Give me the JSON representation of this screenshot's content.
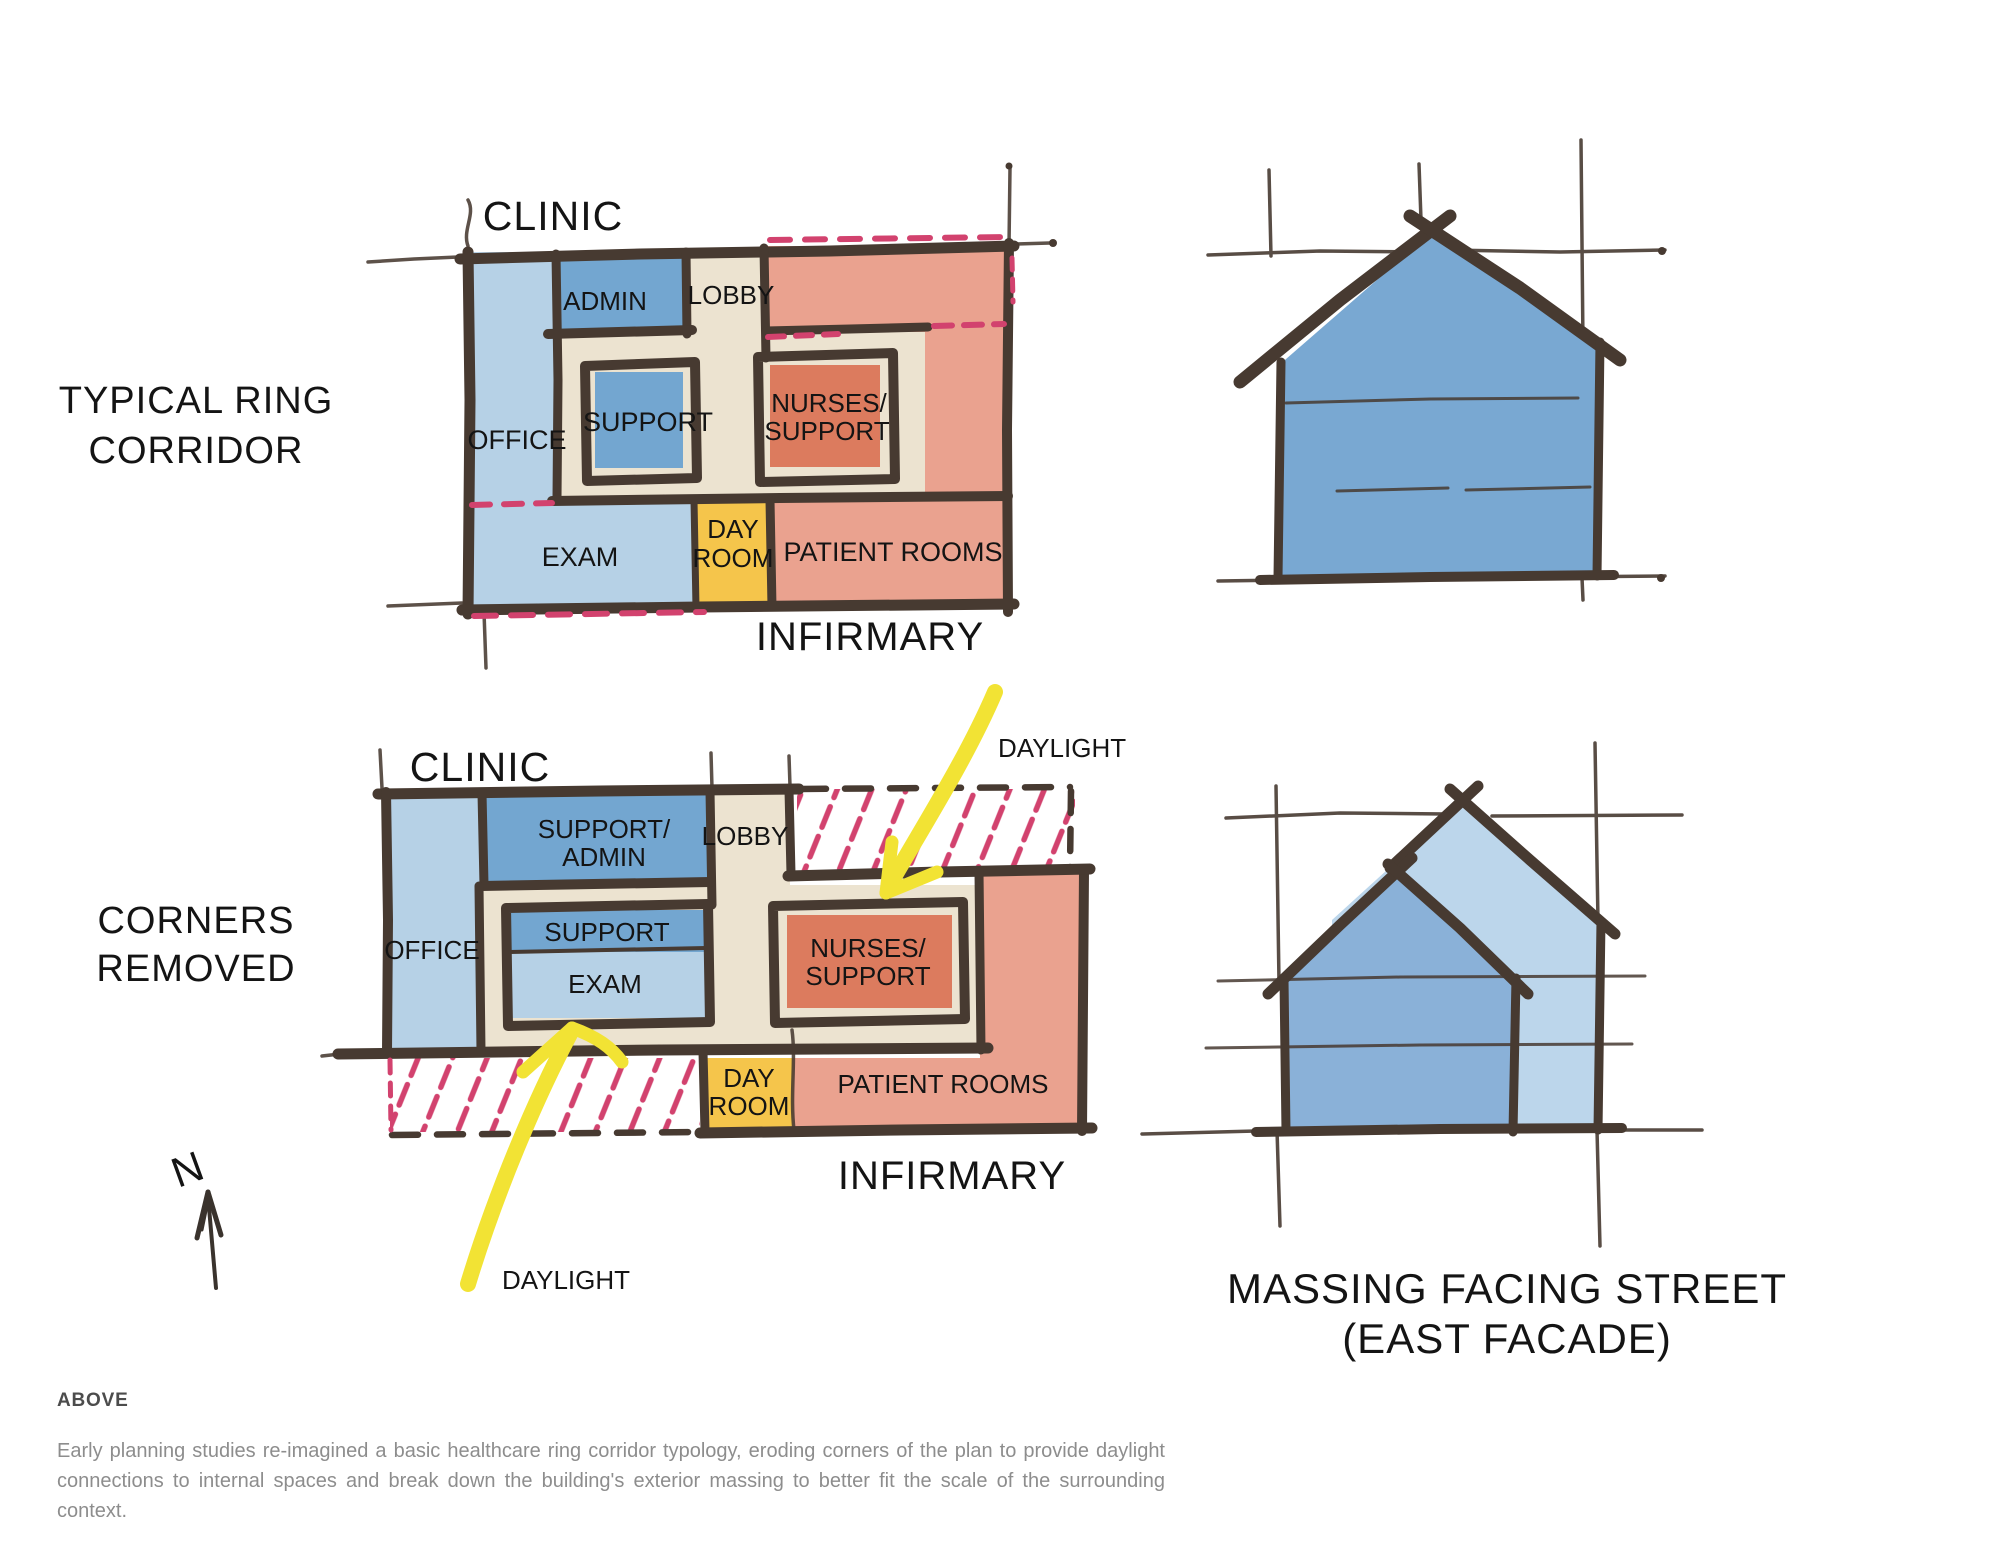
{
  "colors": {
    "ink": "#473a31",
    "light_blue": "#b6d1e6",
    "medium_blue": "#73a6d0",
    "pale_blue_massing": "#bcd6eb",
    "front_blue_massing": "#8ab1d8",
    "cream": "#ece3d0",
    "salmon": "#eaa28f",
    "dark_salmon": "#dc7b5e",
    "day_yellow": "#f5c54b",
    "highlight_yellow": "#f2e334",
    "pink": "#d2426e"
  },
  "plan1": {
    "section_title": [
      "TYPICAL RING",
      "CORRIDOR"
    ],
    "label_top": "CLINIC",
    "label_bottom": "INFIRMARY",
    "rooms": {
      "admin": "ADMIN",
      "lobby": "LOBBY",
      "office": "OFFICE",
      "support": "SUPPORT",
      "nurses": [
        "NURSES/",
        "SUPPORT"
      ],
      "exam": "EXAM",
      "dayroom": [
        "DAY",
        "ROOM"
      ],
      "patient": "PATIENT ROOMS"
    }
  },
  "plan2": {
    "section_title": [
      "CORNERS",
      "REMOVED"
    ],
    "label_top": "CLINIC",
    "label_bottom": "INFIRMARY",
    "rooms": {
      "support_admin": [
        "SUPPORT/",
        "ADMIN"
      ],
      "lobby": "LOBBY",
      "office": "OFFICE",
      "support": "SUPPORT",
      "exam": "EXAM",
      "nurses": [
        "NURSES/",
        "SUPPORT"
      ],
      "dayroom": [
        "DAY",
        "ROOM"
      ],
      "patient": "PATIENT ROOMS"
    },
    "annotations": {
      "daylight_top": "DAYLIGHT",
      "daylight_bottom": "DAYLIGHT"
    }
  },
  "massing": {
    "title": [
      "MASSING FACING STREET",
      "(EAST FACADE)"
    ]
  },
  "compass": {
    "label": "N"
  },
  "caption": {
    "heading": "ABOVE",
    "body": "Early planning studies re-imagined a basic healthcare ring corridor typology, eroding corners of the plan to provide daylight connections to internal spaces and break down the building's exterior massing to better fit the scale of the surrounding context."
  }
}
